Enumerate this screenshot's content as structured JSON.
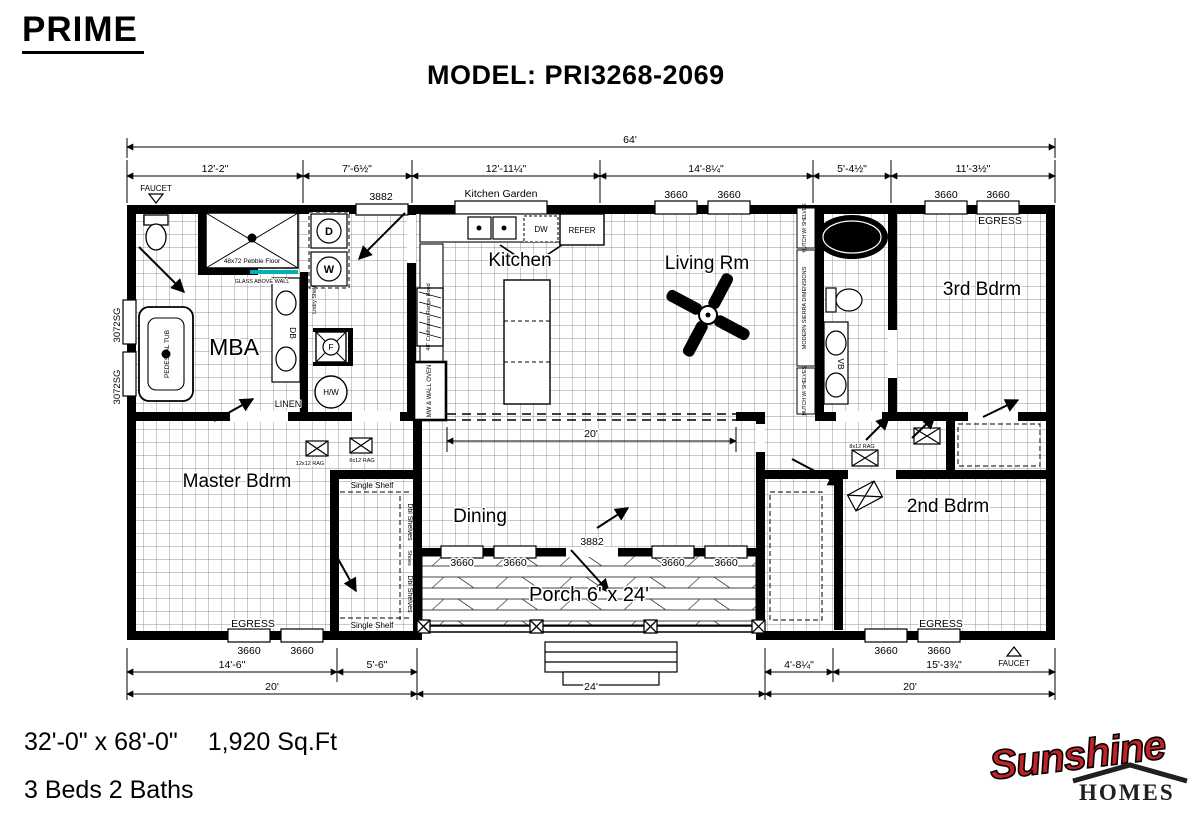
{
  "header": {
    "brand": "PRIME",
    "model": "MODEL: PRI3268-2069"
  },
  "dims": {
    "overall": "64'",
    "top": [
      "12'-2\"",
      "7'-6½\"",
      "12'-11¼\"",
      "14'-8¼\"",
      "5'-4½\"",
      "11'-3½\""
    ],
    "bottom_left": [
      "14'-6\"",
      "5'-6\""
    ],
    "bottom_right": [
      "4'-8¼\"",
      "15'-3¾\""
    ],
    "bottom_totals": [
      "20'",
      "24'",
      "20'"
    ],
    "hall": "20'"
  },
  "rooms": {
    "mba": "MBA",
    "master": "Master Bdrm",
    "kitchen": "Kitchen",
    "living": "Living Rm",
    "dining": "Dining",
    "third": "3rd Bdrm",
    "second": "2nd Bdrm",
    "porch": "Porch 6' x 24'"
  },
  "openings": {
    "w3660": "3660",
    "w3072": "3072SG",
    "d3882": "3882",
    "egress": "EGRESS",
    "faucet": "FAUCET",
    "kitchen_garden": "Kitchen Garden"
  },
  "fixtures": {
    "dryer": "D",
    "washer": "W",
    "db": "DB",
    "linen": "LINEN",
    "hw": "H/W",
    "f": "F",
    "pedestal_tub": "PEDESTAL TUB",
    "shower_floor": "48x72 Pebble Floor",
    "glass_wall": "GLASS ABOVE WALL",
    "lndry_shelf": "Lndry Shelf",
    "dw": "DW",
    "refer": "REFER",
    "range_hood": "48\" Craftsman Range Hood",
    "wall_oven": "MW & WALL OVEN",
    "tub2_model": "56043",
    "tub2_tag": "#2BA",
    "vb": "VB",
    "ent_center": "MODERN SIERRA DIMENSIONS",
    "hutch": "HUTCH W/ SHELVES",
    "single_shelf": "Single Shelf",
    "dbl_shelves": "Dbl Shelves",
    "shoes": "Shoes",
    "rag12": "12x12 RAG",
    "rag8": "8x12 RAG"
  },
  "footer": {
    "size": "32'-0\" x 68'-0\"",
    "sqft": "1,920 Sq.Ft",
    "beds": "3 Beds 2 Baths"
  },
  "logo": {
    "name": "Sunshine",
    "sub": "HOMES"
  },
  "colors": {
    "glass_accent": "#00b2b2",
    "logo_red": "#c42127",
    "logo_dark": "#231f20",
    "ink": "#000000"
  }
}
